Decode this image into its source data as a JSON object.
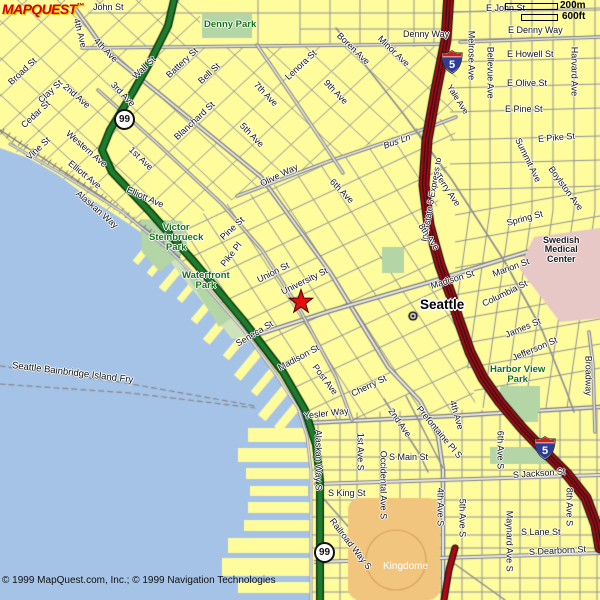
{
  "logo": {
    "text": "MAPQUEST",
    "tm": "™"
  },
  "scale": {
    "metric": "200m",
    "imperial": "600ft"
  },
  "attribution": {
    "text": "© 1999 MapQuest.com, Inc.; © 1999 Navigation Technologies"
  },
  "city": {
    "name": "Seattle"
  },
  "shields": {
    "interstate": "5",
    "state_route": "99"
  },
  "map": {
    "labels": [
      {
        "t": "John St",
        "x": 93,
        "y": 8
      },
      {
        "t": "E John St",
        "x": 486,
        "y": 9
      },
      {
        "t": "Denny Park",
        "x": 204,
        "y": 25,
        "c": "park",
        "n": "park-label"
      },
      {
        "t": "Denny Way",
        "x": 403,
        "y": 35
      },
      {
        "t": "E Denny Way",
        "x": 508,
        "y": 31
      },
      {
        "t": "E Howell St",
        "x": 507,
        "y": 55
      },
      {
        "t": "E Olive St",
        "x": 507,
        "y": 84
      },
      {
        "t": "E Pine St",
        "x": 505,
        "y": 110
      },
      {
        "t": "E Pike St",
        "x": 538,
        "y": 140,
        "r": -5
      },
      {
        "t": "Melrose Ave",
        "x": 471,
        "y": 31,
        "r": 90
      },
      {
        "t": "Bellevue Ave",
        "x": 490,
        "y": 47,
        "r": 90
      },
      {
        "t": "Harvard Ave",
        "x": 574,
        "y": 47,
        "r": 90
      },
      {
        "t": "Yale Ave",
        "x": 449,
        "y": 86,
        "r": 58,
        "s": 8.5
      },
      {
        "t": "Summit Ave",
        "x": 517,
        "y": 139,
        "r": 64
      },
      {
        "t": "Boylston Ave",
        "x": 550,
        "y": 168,
        "r": 54
      },
      {
        "t": "Boren Ave",
        "x": 338,
        "y": 35,
        "r": 44
      },
      {
        "t": "Minor Ave",
        "x": 379,
        "y": 38,
        "r": 44
      },
      {
        "t": "Lenora St",
        "x": 287,
        "y": 79,
        "r": -43
      },
      {
        "t": "7th Ave",
        "x": 255,
        "y": 84,
        "r": 46
      },
      {
        "t": "9th Ave",
        "x": 325,
        "y": 82,
        "r": 46
      },
      {
        "t": "Bell St",
        "x": 200,
        "y": 83,
        "r": -43
      },
      {
        "t": "Blanchard St",
        "x": 176,
        "y": 139,
        "r": -43
      },
      {
        "t": "5th Ave",
        "x": 241,
        "y": 125,
        "r": 46
      },
      {
        "t": "Wall St",
        "x": 134,
        "y": 78,
        "r": -43
      },
      {
        "t": "Battery St",
        "x": 168,
        "y": 77,
        "r": -43
      },
      {
        "t": "Broad St",
        "x": 10,
        "y": 84,
        "r": -43
      },
      {
        "t": "Clay St",
        "x": 40,
        "y": 102,
        "r": -43
      },
      {
        "t": "4th Ave",
        "x": 76,
        "y": 19,
        "r": 76
      },
      {
        "t": "4th Ave",
        "x": 95,
        "y": 40,
        "r": 46
      },
      {
        "t": "2nd Ave",
        "x": 64,
        "y": 86,
        "r": 41
      },
      {
        "t": "3rd Ave",
        "x": 112,
        "y": 84,
        "r": 46
      },
      {
        "t": "Cedar St",
        "x": 23,
        "y": 127,
        "r": -43
      },
      {
        "t": "Vine St",
        "x": 28,
        "y": 159,
        "r": -43
      },
      {
        "t": "Western Ave",
        "x": 67,
        "y": 133,
        "r": 41
      },
      {
        "t": "1st Ave",
        "x": 130,
        "y": 149,
        "r": 44
      },
      {
        "t": "Elliott Ave",
        "x": 69,
        "y": 163,
        "r": 39
      },
      {
        "t": "Elliott Ave",
        "x": 127,
        "y": 190,
        "r": 24
      },
      {
        "t": "Alaskan Way",
        "x": 77,
        "y": 193,
        "r": 41
      },
      {
        "t": "Victor\nSteinbrueck\nPark",
        "x": 149,
        "y": 228,
        "c": "park multi",
        "n": "park-label"
      },
      {
        "t": "Waterfront\nPark",
        "x": 182,
        "y": 276,
        "c": "park multi",
        "n": "park-label"
      },
      {
        "t": "Pine St",
        "x": 222,
        "y": 239,
        "r": -43
      },
      {
        "t": "Pike Pl",
        "x": 223,
        "y": 266,
        "r": -52
      },
      {
        "t": "Olive Way",
        "x": 261,
        "y": 185,
        "r": -26
      },
      {
        "t": "6th Ave",
        "x": 331,
        "y": 181,
        "r": 46
      },
      {
        "t": "Bus Ln",
        "x": 384,
        "y": 147,
        "r": -20,
        "c": "it"
      },
      {
        "t": "Interstate 5 Express to",
        "x": 424,
        "y": 242,
        "r": -80,
        "s": 8.5,
        "n": "highway-label"
      },
      {
        "t": "Terry Ave",
        "x": 437,
        "y": 175,
        "r": 56
      },
      {
        "t": "8th Ave",
        "x": 420,
        "y": 225,
        "r": 56
      },
      {
        "t": "Union St",
        "x": 258,
        "y": 281,
        "r": -27
      },
      {
        "t": "University St",
        "x": 282,
        "y": 293,
        "r": -26
      },
      {
        "t": "Spring St",
        "x": 507,
        "y": 224,
        "r": -15
      },
      {
        "t": "Seneca St",
        "x": 237,
        "y": 345,
        "r": -31
      },
      {
        "t": "Madison St",
        "x": 279,
        "y": 369,
        "r": -28
      },
      {
        "t": "Madison St",
        "x": 431,
        "y": 287,
        "r": -17
      },
      {
        "t": "Marion St",
        "x": 493,
        "y": 275,
        "r": -20
      },
      {
        "t": "Columbia St",
        "x": 483,
        "y": 305,
        "r": -26
      },
      {
        "t": "Post Ave",
        "x": 314,
        "y": 366,
        "r": 53
      },
      {
        "t": "Cherry St",
        "x": 352,
        "y": 395,
        "r": -26
      },
      {
        "t": "James St",
        "x": 506,
        "y": 336,
        "r": -23
      },
      {
        "t": "Jefferson St",
        "x": 513,
        "y": 359,
        "r": -23
      },
      {
        "t": "Harbor View\nPark",
        "x": 490,
        "y": 370,
        "c": "park multi",
        "n": "park-label"
      },
      {
        "t": "Broadway",
        "x": 588,
        "y": 356,
        "r": 90
      },
      {
        "t": "Swedish\nMedical\nCenter",
        "x": 543,
        "y": 241,
        "c": "fac multi",
        "n": "facility-label"
      },
      {
        "t": "Seattle",
        "x": 420,
        "y": 303,
        "c": "city",
        "n": "city-label"
      },
      {
        "t": "Yesler Way",
        "x": 304,
        "y": 417,
        "r": -7
      },
      {
        "t": "2nd Ave",
        "x": 390,
        "y": 410,
        "r": 55
      },
      {
        "t": "1st Ave S",
        "x": 360,
        "y": 433,
        "r": 90
      },
      {
        "t": "Alaskan Way S",
        "x": 318,
        "y": 430,
        "r": 90
      },
      {
        "t": "Occidental Ave S",
        "x": 383,
        "y": 451,
        "r": 90
      },
      {
        "t": "S Main St",
        "x": 389,
        "y": 458
      },
      {
        "t": "S King St",
        "x": 328,
        "y": 494
      },
      {
        "t": "4th Ave S",
        "x": 440,
        "y": 488,
        "r": 90
      },
      {
        "t": "4th Ave",
        "x": 452,
        "y": 401,
        "r": 74
      },
      {
        "t": "5th Ave S",
        "x": 462,
        "y": 499,
        "r": 90
      },
      {
        "t": "6th Ave S",
        "x": 500,
        "y": 431,
        "r": 90
      },
      {
        "t": "8th Ave S",
        "x": 569,
        "y": 488,
        "r": 90
      },
      {
        "t": "Maynard Ave S",
        "x": 509,
        "y": 511,
        "r": 90
      },
      {
        "t": "S Jackson St",
        "x": 513,
        "y": 476,
        "r": -4
      },
      {
        "t": "S Lane St",
        "x": 521,
        "y": 533
      },
      {
        "t": "S Dearborn St",
        "x": 529,
        "y": 553,
        "r": -3
      },
      {
        "t": "Railroad Way S",
        "x": 331,
        "y": 520,
        "r": 52
      },
      {
        "t": "Prefontaine Pl S",
        "x": 418,
        "y": 408,
        "r": 50
      },
      {
        "t": "Kingdome",
        "x": 383,
        "y": 567,
        "c": "white",
        "s": 10,
        "n": "stadium-label"
      },
      {
        "t": "Seattle Bainbridge Island Fry",
        "x": 12,
        "y": 366,
        "r": 7,
        "s": 9.5,
        "n": "ferry-route-label"
      }
    ]
  }
}
